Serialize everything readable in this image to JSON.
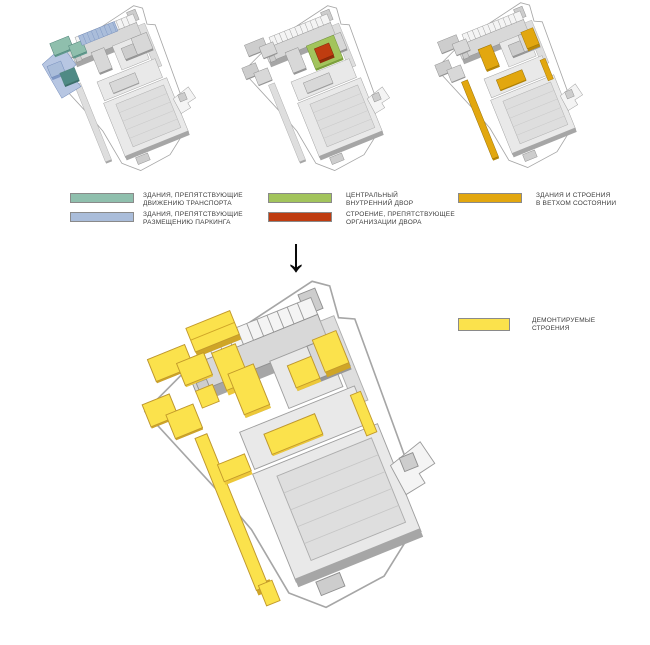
{
  "palette": {
    "teal": "#8fbfad",
    "teal_side": "#5f988c",
    "teal_deep": "#4f8a85",
    "teal_deep_side": "#3c6f6b",
    "blue": "#aabdda",
    "blue_side": "#7e97c4",
    "blue_plot": "#b7c6e2",
    "green": "#a2c45c",
    "green_side": "#7ea13e",
    "red": "#bf3c10",
    "red_side": "#8f2b0a",
    "gold": "#e2a70f",
    "gold_side": "#b98806",
    "yellow": "#fbe24c",
    "yellow_side": "#edc838",
    "yellow_deep": "#cfa527"
  },
  "legends": {
    "transport": {
      "items": [
        {
          "line1": "ЗДАНИЯ, ПРЕПЯТСТВУЮЩИЕ",
          "line2": "ДВИЖЕНИЮ ТРАНСПОРТА"
        },
        {
          "line1": "ЗДАНИЯ, ПРЕПЯТСТВУЮЩИЕ",
          "line2": "РАЗМЕЩЕНИЮ ПАРКИНГА"
        }
      ]
    },
    "courtyard": {
      "items": [
        {
          "line1": "ЦЕНТРАЛЬНЫЙ",
          "line2": "ВНУТРЕННИЙ ДВОР"
        },
        {
          "line1": "СТРОЕНИЕ, ПРЕПЯТСТВУЮЩЕЕ",
          "line2": "ОРГАНИЗАЦИИ ДВОРА"
        }
      ]
    },
    "dilapidated": {
      "items": [
        {
          "line1": "ЗДАНИЯ И СТРОЕНИЯ",
          "line2": "В ВЕТХОМ СОСТОЯНИИ"
        }
      ]
    },
    "demolition": {
      "items": [
        {
          "line1": "ДЕМОНТИРУЕМЫЕ",
          "line2": "СТРОЕНИЯ"
        }
      ]
    }
  },
  "arrow": {
    "glyph": "↓"
  }
}
